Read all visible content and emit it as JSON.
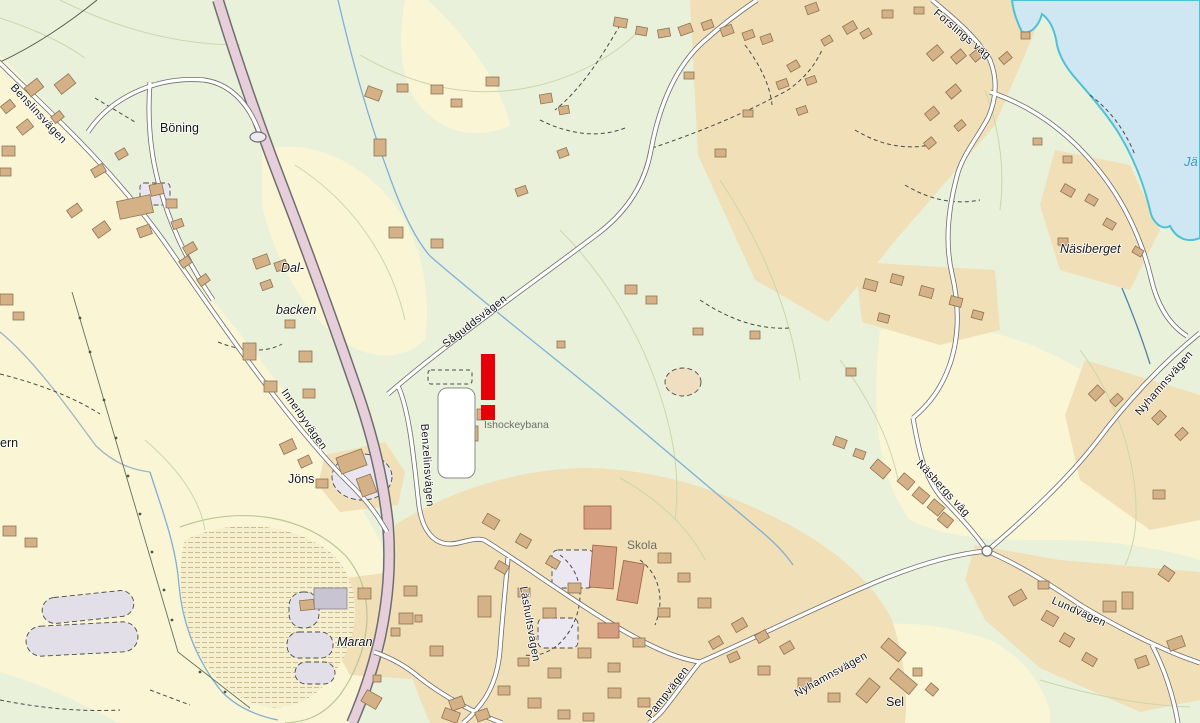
{
  "map": {
    "kind": "topographic-map",
    "labels": {
      "benslinsvagen": "Benslinsvägen",
      "boning": "Böning",
      "dal": "Dal-",
      "backen": "backen",
      "innerbyvagen": "Innerbyvägen",
      "jons": "Jöns",
      "benzelinsvagen": "Benzelinsvägen",
      "saguddsvagen": "Såguddsvägen",
      "ishockeybana": "Ishockeybana",
      "maran": "Maran",
      "skola": "Skola",
      "lashultsvagen": "Läshultsvägen",
      "pampvagen": "Pampvägen",
      "nyhamnsvagen_south": "Nyhamnsvägen",
      "sel": "Sel",
      "nasbergs_vag": "Näsbergs väg",
      "nyhamnsvagen_east": "Nyhamnsvägen",
      "nasiberget": "Näsiberget",
      "forslings_vag": "Forslings väg",
      "lundvagen": "Lundvägen",
      "water_partial": "Jä",
      "ern_partial": "ern"
    },
    "marker": {
      "symbol": "!",
      "color": "#e60008"
    },
    "colors": {
      "field_green": "#e9f1da",
      "field_yellow": "#faf5d4",
      "residential_tan": "#f0dfb7",
      "building": "#d5b187",
      "building_outline": "#8d7553",
      "school_building": "#d69e81",
      "gray_building": "#c8c4d1",
      "road_fill": "#ffffff",
      "road_casing": "#6e6e6e",
      "major_road": "#e6cedb",
      "water": "#cfe7f2",
      "shoreline": "#4cc2d8",
      "stream": "#7fb0d6",
      "contour": "#ccd6ad",
      "muted_label": "#6f6f66",
      "water_label": "#3a9bc7"
    }
  }
}
